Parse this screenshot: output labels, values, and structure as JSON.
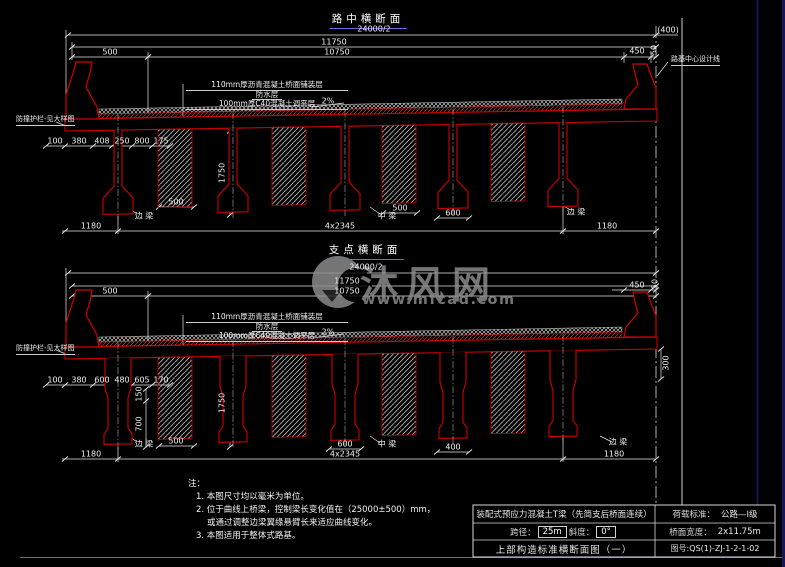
{
  "colors": {
    "beam_red": "#d00000",
    "dim_white": "#efefef",
    "frame_navy": "#16165a",
    "watermark_gray": "#8f8f8f",
    "title_underline": "#6a6ae0"
  },
  "watermark": {
    "logo": "mfcad-logo",
    "brand": "沐风网",
    "url": "www.mfcad.com"
  },
  "sections": [
    {
      "title": "路中横断面",
      "dim_half_width": "24000/2",
      "dim_total": "11750",
      "dim_clear": "10750",
      "dim_barrier": "500",
      "edge_dims": [
        "100",
        "380",
        "408",
        "250",
        "800",
        "175"
      ],
      "layer_notes": [
        "110mm厚沥青混凝土桥面铺装层",
        "防水层",
        "100mm厚C40混凝土调平层"
      ],
      "slope": "2%",
      "dim_beam_height": "1750",
      "dim_d1": "500",
      "dim_d2": "500",
      "dim_d3": "600",
      "chain": [
        "1180",
        "4x2345",
        "1180"
      ],
      "label_edge_left": "边 梁",
      "label_mid": "中 梁",
      "label_edge_right": "边 梁",
      "dim_right_a": "450",
      "dim_right_b": "50",
      "dim_gap": "(400)",
      "centerline_label": "路基中心设计线",
      "barrier_label": "防撞护栏-见大样图"
    },
    {
      "title": "支点横断面",
      "dim_half_width": "24000/2",
      "dim_total": "11750",
      "dim_clear": "10750",
      "dim_barrier": "500",
      "edge_dims": [
        "100",
        "380",
        "600",
        "480",
        "605",
        "170"
      ],
      "layer_notes": [
        "110mm厚沥青混凝土桥面铺装层",
        "防水层",
        "100mm厚C40混凝土调平层"
      ],
      "slope": "2%",
      "dim_beam_height": "1750",
      "dim_web_a": "150",
      "dim_web_b": "700",
      "dim_d1": "500",
      "dim_d2": "600",
      "dim_d3": "400",
      "chain": [
        "1180",
        "4x2345",
        "1180"
      ],
      "label_edge_left": "边 梁",
      "label_mid": "中 梁",
      "label_edge_right": "边 梁",
      "dim_right_a": "450",
      "dim_right_b": "50",
      "dim_edge_depth": "300",
      "barrier_label": "防撞护栏-见大样图"
    }
  ],
  "notes": {
    "heading": "注：",
    "items": [
      "1. 本图尺寸均以毫米为单位。",
      "2. 位于曲线上桥梁，控制梁长变化值在（25000±500）mm，",
      "或通过调整边梁翼缘悬臂长来适应曲线变化。",
      "3. 本图适用于整体式路基。"
    ]
  },
  "titleblock": {
    "project": "装配式预应力混凝土T梁（先简支后桥面连续）",
    "span_label": "跨径：",
    "span_value": "25m",
    "skew_label": "斜度：",
    "skew_value": "0°",
    "drawing_title": "上部构造标准横断面图（一）",
    "load_label": "荷载标准：",
    "load_value": "公路—I级",
    "width_label": "桥面宽度：",
    "width_value": "2x11.75m",
    "number_label": "图号:",
    "number_value": "QS(1)-ZJ-1-2-1-02"
  }
}
